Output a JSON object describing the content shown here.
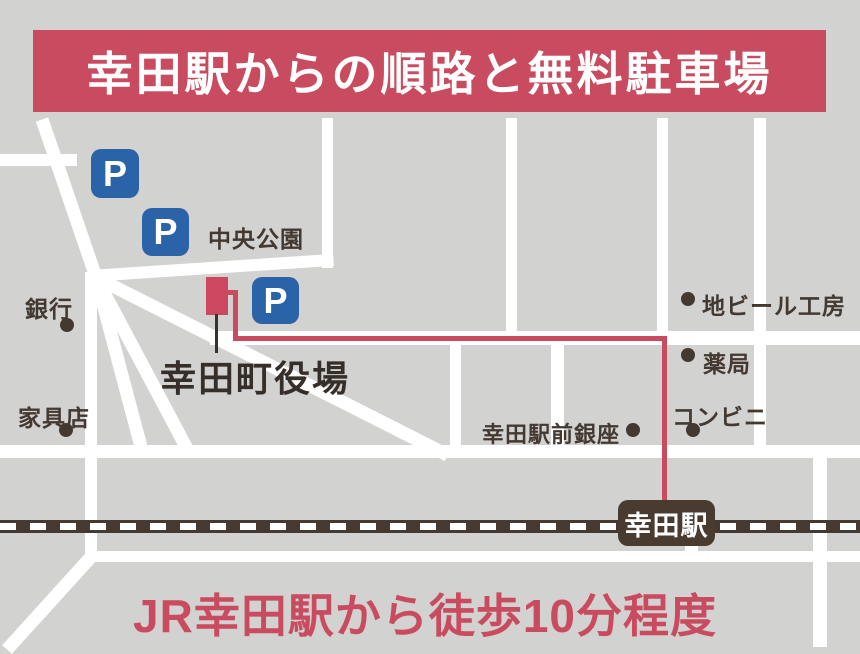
{
  "title": {
    "text": "幸田駅からの順路と無料駐車場"
  },
  "footer": {
    "text": "JR幸田駅から徒歩10分程度"
  },
  "station": {
    "name": "幸田駅"
  },
  "destination": {
    "name": "幸田町役場"
  },
  "parking": {
    "symbol": "P"
  },
  "places": {
    "central_park": "中央公園",
    "bank": "銀行",
    "furniture_store": "家具店",
    "beer_brewery": "地ビール工房",
    "pharmacy": "薬局",
    "convenience_store": "コンビニ",
    "ekimae_ginza": "幸田駅前銀座"
  },
  "colors": {
    "accent_crimson": "#c94b5f",
    "parking_blue": "#2b63a9",
    "dark_brown": "#453931",
    "road_white": "#ffffff",
    "map_gray": "#d2d2d1"
  }
}
